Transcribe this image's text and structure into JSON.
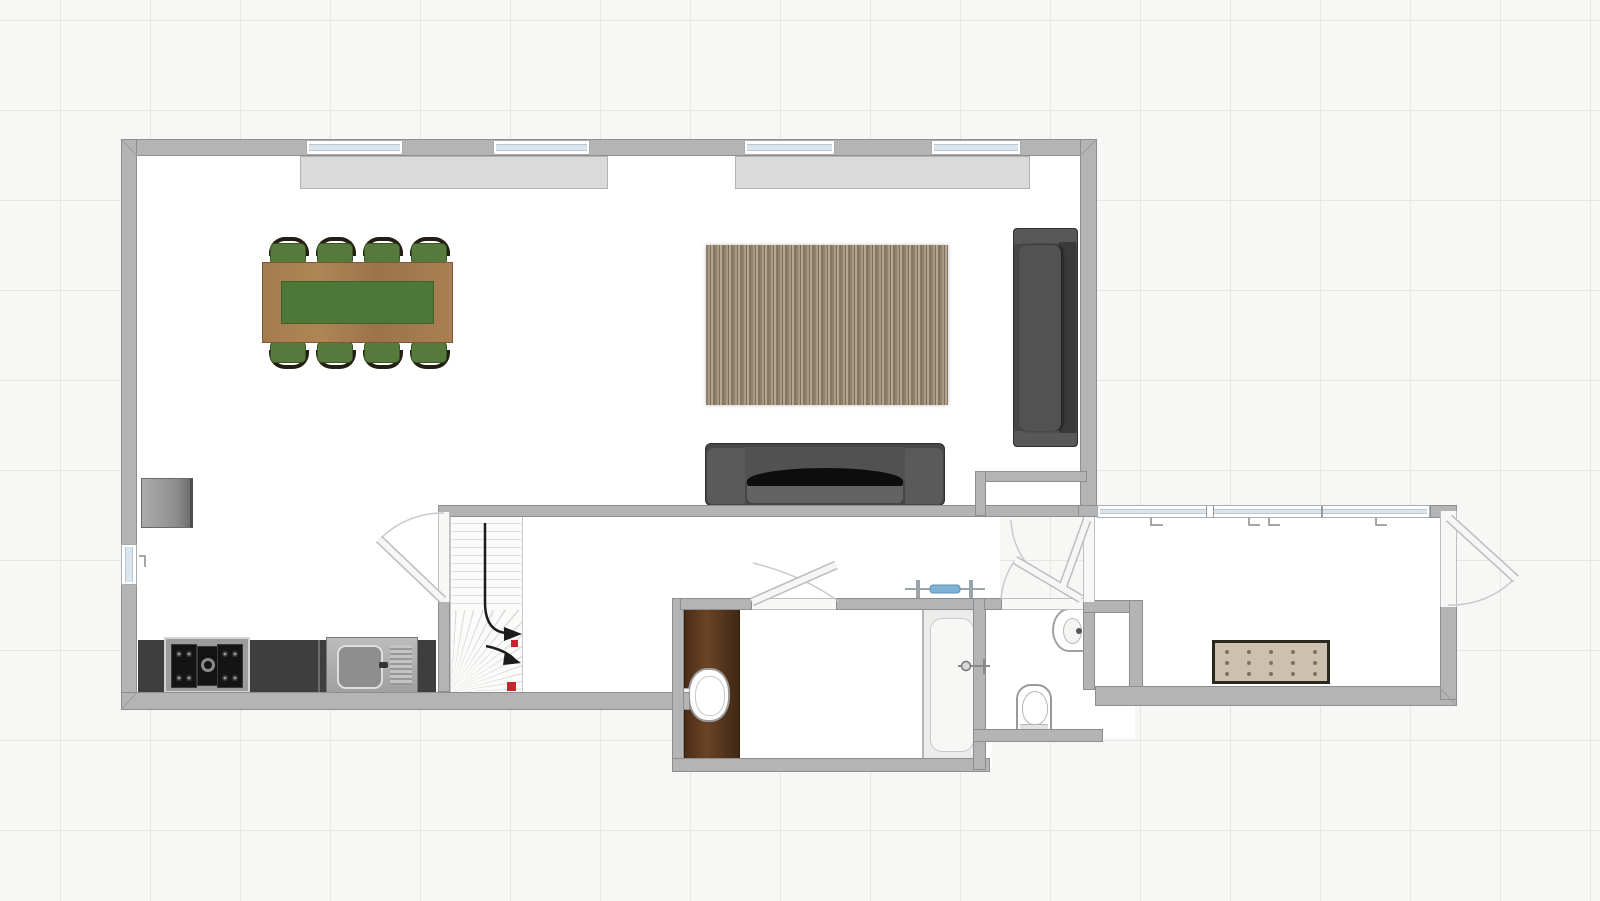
{
  "app": {
    "type": "floor-plan-editor-canvas",
    "view": "2d-top-down",
    "visible_text": "none"
  },
  "palette": {
    "background": "#f7f7f5",
    "grid_line": "#e6e6e4",
    "grid_spacing_px": 90,
    "wall_fill": "#b4b4b4",
    "wall_edge": "#8e8e8e",
    "floor": "#ffffff",
    "window_glass": "#d9e6ef",
    "radiator": "#dadada",
    "kitchen_counter": "#3f3e3e",
    "stainless": "#b0b0b0",
    "table_wood": "#a87e50",
    "table_runner_green": "#4d7837",
    "chair_seat_green": "#567a3b",
    "chair_frame_wood": "#241d12",
    "rug_brown_stripes": [
      "#91816c",
      "#a99a82",
      "#7b6d5e",
      "#b6a78e"
    ],
    "sofa_gray": "#474747",
    "vanity_wood": "#5a3a20",
    "bench_beige": "#cbc1ae",
    "stair_tread": "#fbfbfa",
    "direction_arrow": "#1c1c1c",
    "marker_red": "#c1272d",
    "fixture_blue": "#7fb2d4",
    "fixture_gray": "#9aa5ab"
  },
  "inventory": {
    "rooms": [
      {
        "name": "open-plan-living-dining-kitchen"
      },
      {
        "name": "stair-hall"
      },
      {
        "name": "corridor"
      },
      {
        "name": "bathroom"
      },
      {
        "name": "wc"
      },
      {
        "name": "entry-hallway"
      }
    ],
    "furniture": [
      {
        "name": "dining-table",
        "chairs": 8,
        "runner": "green"
      },
      {
        "name": "striped-area-rug"
      },
      {
        "name": "sofa-right-facing-left"
      },
      {
        "name": "loveseat-bottom"
      },
      {
        "name": "refrigerator"
      },
      {
        "name": "gas-cooktop",
        "burners": 5
      },
      {
        "name": "kitchen-sink-with-drainer"
      },
      {
        "name": "staircase",
        "flights": 2
      },
      {
        "name": "bathroom-vanity-with-sink"
      },
      {
        "name": "bathtub"
      },
      {
        "name": "toilet"
      },
      {
        "name": "corner-hand-basin"
      },
      {
        "name": "tufted-bench",
        "tuft_rows": 3,
        "tuft_cols": 5
      }
    ],
    "openings": {
      "windows_top_wall": 4,
      "window_left_wall": 1,
      "window_band_hallway_segments": 3,
      "radiator_panels": 2,
      "doors_interior": 4,
      "door_entry": 1
    },
    "annotations": {
      "stair_direction_arrows": 2,
      "red_markers": 2,
      "window_vent_ticks": 5
    }
  }
}
